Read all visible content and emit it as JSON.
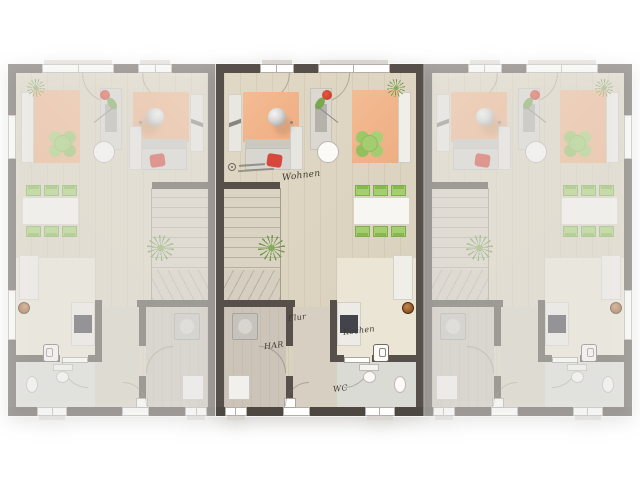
{
  "plan": {
    "type": "row-house-floor-plan",
    "highlighted_unit": "middle",
    "units": [
      {
        "id": "unit-left",
        "mirrored": true,
        "faded": true,
        "edge": true,
        "show_labels": false
      },
      {
        "id": "unit-middle",
        "mirrored": false,
        "faded": false,
        "edge": false,
        "show_labels": true
      },
      {
        "id": "unit-right",
        "mirrored": false,
        "faded": true,
        "edge": true,
        "show_labels": false
      }
    ],
    "labels": {
      "living": "Wohnen",
      "hall": "Flur",
      "utility": "HAR",
      "kitchen": "Kochen",
      "wc": "WC"
    },
    "colors": {
      "wall": "#57504a",
      "floor_living": "#dcd4c0",
      "floor_kitchen": "#ebe5d5",
      "floor_utility": "#ccc4b9",
      "floor_wc": "#dbdbd5",
      "rug_orange": "#f1b58e",
      "accent_green": "#a5ce71",
      "accent_red": "#d6483c",
      "chimney_badge": "#9c5c2b",
      "background": "#ffffff"
    }
  }
}
